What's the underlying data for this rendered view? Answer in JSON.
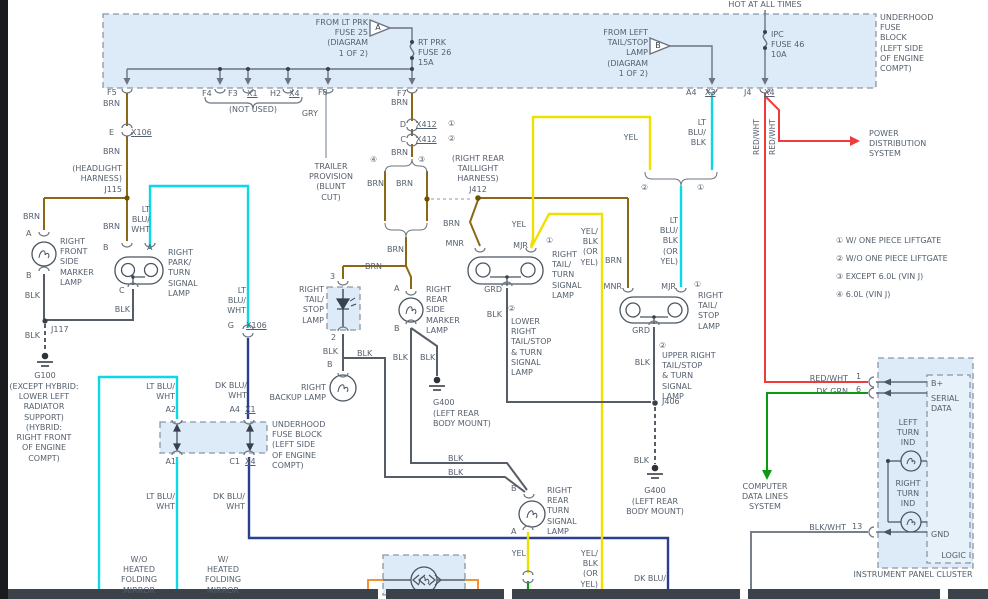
{
  "d": {
    "top_block": {
      "hot": "HOT AT ALL TIMES",
      "from_lt_prk": "FROM LT PRK\nFUSE 25\n(DIAGRAM\n1 OF 2)",
      "tri_a": "A",
      "rt_prk": "RT PRK\nFUSE 26\n15A",
      "from_left_tail": "FROM LEFT\nTAIL/STOP\nLAMP\n(DIAGRAM\n1 OF 2)",
      "tri_b": "B",
      "ipc_fuse": "IPC\nFUSE 46\n10A",
      "name": "UNDERHOOD\nFUSE\nBLOCK\n(LEFT SIDE\nOF ENGINE\nCOMPT)",
      "not_used": "(NOT USED)",
      "pins": {
        "f5": "F5",
        "f4": "F4",
        "f3": "F3",
        "x1": "X1",
        "h2": "H2",
        "x4": "X4",
        "f8": "F8",
        "f7": "F7",
        "a4": "A4",
        "x3": "X3",
        "j4": "J4",
        "x4b": "X4"
      }
    },
    "wire": {
      "brn": "BRN",
      "blk": "BLK",
      "gry": "GRY",
      "yel": "YEL",
      "red_wht": "RED/WHT",
      "dk_grn": "DK GRN",
      "blk_wht": "BLK/WHT",
      "lt_blu_wht2": "LT BLU/\nWHT",
      "lt_blu_wht3": "LT\nBLU/\nWHT",
      "dk_blu_wht2": "DK BLU/\nWHT",
      "dk_blu_cut": "DK BLU/",
      "lt_blu_blk3": "LT\nBLU/\nBLK",
      "lt_blu_blk_or": "LT\nBLU/\nBLK\n(OR\nYEL)",
      "yel_blk_or": "YEL/\nBLK\n(OR\nYEL)"
    },
    "conn": {
      "e": "E",
      "x106": "X106",
      "g": "G",
      "d": "D",
      "c": "C",
      "x412": "X412",
      "ref1": "①",
      "ref2": "②",
      "ref3": "③",
      "ref4": "④",
      "j115": "J115",
      "j117": "J117",
      "j406": "J406",
      "headlight_harness": "(HEADLIGHT\nHARNESS)",
      "j412_note": "(RIGHT REAR\nTAILLIGHT\nHARNESS)\nJ412",
      "a2": "A2",
      "a1": "A1",
      "a4": "A4",
      "x1": "X1",
      "c1": "C1",
      "x4": "X4"
    },
    "pin": {
      "a": "A",
      "b": "B",
      "c": "C",
      "n2": "2",
      "n3": "3",
      "mnr": "MNR",
      "mjr": "MJR",
      "grd": "GRD",
      "n1": "1",
      "n6": "6",
      "n13": "13"
    },
    "comp": {
      "front_marker": "RIGHT\nFRONT\nSIDE\nMARKER\nLAMP",
      "park_turn": "RIGHT\nPARK/\nTURN\nSIGNAL\nLAMP",
      "trailer": "TRAILER\nPROVISION\n(BLUNT\nCUT)",
      "tail_stop_led": "RIGHT\nTAIL/\nSTOP\nLAMP",
      "backup": "RIGHT\nBACKUP LAMP",
      "rear_marker": "RIGHT\nREAR\nSIDE\nMARKER\nLAMP",
      "underhood2": "UNDERHOOD\nFUSE BLOCK\n(LEFT SIDE\nOF ENGINE\nCOMPT)",
      "tail_turn": "RIGHT\nTAIL/\nTURN\nSIGNAL\nLAMP",
      "lower_right": "LOWER\nRIGHT\nTAIL/STOP\n& TURN\nSIGNAL\nLAMP",
      "tail_stop2": "RIGHT\nTAIL/\nSTOP\nLAMP",
      "upper_right": "UPPER RIGHT\nTAIL/STOP\n& TURN\nSIGNAL\nLAMP",
      "rear_turn": "RIGHT\nREAR\nTURN\nSIGNAL\nLAMP",
      "g100": "G100",
      "g100_note": "(EXCEPT HYBRID:\nLOWER LEFT\nRADIATOR\nSUPPORT)\n(HYBRID:\nRIGHT FRONT\nOF ENGINE\nCOMPT)",
      "g400": "G400",
      "g400_note": "(LEFT REAR\nBODY MOUNT)",
      "wo_mirror": "W/O\nHEATED\nFOLDING\nMIRROR",
      "w_mirror": "W/\nHEATED\nFOLDING\nMIRROR",
      "power_dist": "POWER\nDISTRIBUTION\nSYSTEM",
      "computer": "COMPUTER\nDATA LINES\nSYSTEM"
    },
    "ipc": {
      "title": "INSTRUMENT PANEL CLUSTER",
      "logic": "LOGIC",
      "bplus": "B+",
      "serial": "SERIAL\nDATA",
      "gnd": "GND",
      "left_turn": "LEFT\nTURN\nIND",
      "right_turn": "RIGHT\nTURN\nIND"
    },
    "notes": [
      "① W/ ONE PIECE LIFTGATE",
      "② W/O ONE PIECE LIFTGATE",
      "③ EXCEPT 6.0L (VIN J)",
      "④ 6.0L (VIN J)"
    ],
    "colors": {
      "brn": "#8B6914",
      "blk": "#565d66",
      "gry": "#b6bdc5",
      "yel": "#f0e000",
      "lt_blu": "#0cd8e8",
      "dk_blu": "#2b3f90",
      "red": "#ef3b3b",
      "dk_grn": "#0c9b10",
      "org": "#f59133",
      "box_fill": "#dcebf7",
      "text": "#55606e"
    }
  }
}
